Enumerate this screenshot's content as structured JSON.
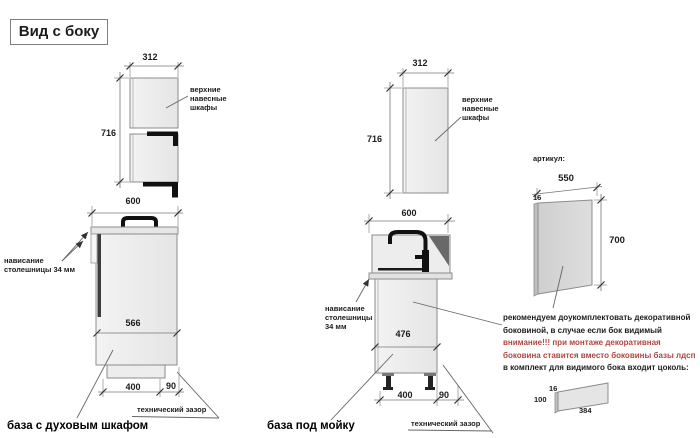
{
  "title": "Вид с боку",
  "left": {
    "upper": {
      "width": "312",
      "height": "716",
      "label1": "верхние навесные",
      "label2": "шкафы"
    },
    "base": {
      "width": "600",
      "inner": "566",
      "plinth": "400",
      "gap": "90",
      "overhang1": "нависание",
      "overhang2": "столешницы 34 мм",
      "tech_gap": "технический зазор",
      "caption": "база с духовым шкафом"
    }
  },
  "middle": {
    "upper": {
      "width": "312",
      "height": "716",
      "label1": "верхние навесные",
      "label2": "шкафы"
    },
    "base": {
      "width": "600",
      "inner": "476",
      "plinth": "400",
      "gap": "90",
      "overhang1": "нависание",
      "overhang2": "столешницы",
      "overhang3": "34 мм",
      "tech_gap": "технический зазор",
      "caption": "база под мойку"
    }
  },
  "right": {
    "article_label": "артикул:",
    "panel": {
      "width": "550",
      "thickness": "16",
      "height": "700"
    },
    "notes": [
      "рекомендуем доукомплектовать декоративной",
      "боковиной, в случае если бок видимый",
      "внимание!!! при монтаже декоративная",
      "боковина ставится вместо боковины базы лдсп",
      "в комплект для видимого бока входит цоколь:"
    ],
    "plinth": {
      "thickness": "16",
      "height": "100",
      "width": "384"
    }
  },
  "colors": {
    "warning": "#b04540",
    "line": "#8c8c8c",
    "dim_text": "#1c1c1c"
  }
}
